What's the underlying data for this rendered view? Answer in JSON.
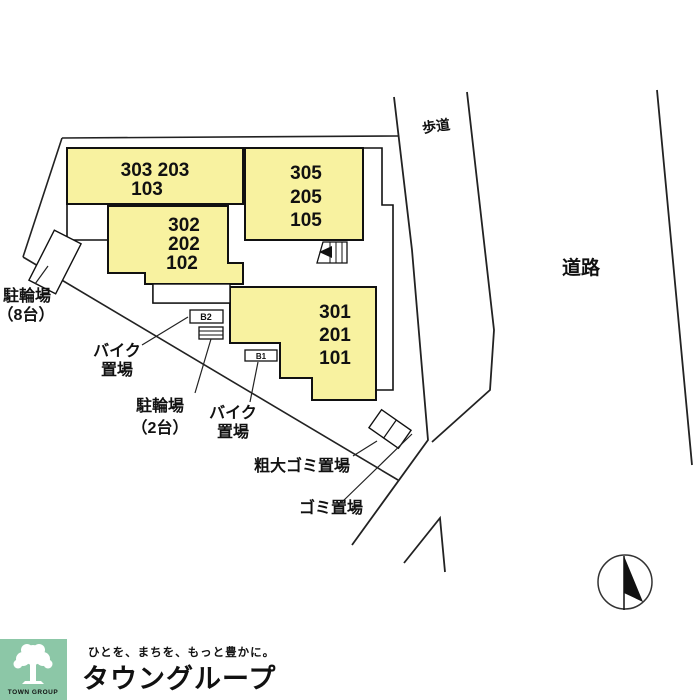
{
  "plan": {
    "area_labels": {
      "sidewalk": "歩道",
      "road": "道路"
    },
    "blocks": {
      "a": {
        "lines": [
          "303 203",
          "103"
        ]
      },
      "b": {
        "lines": [
          "302",
          "202",
          "102"
        ]
      },
      "c": {
        "lines": [
          "305",
          "205",
          "105"
        ]
      },
      "d": {
        "lines": [
          "301",
          "201",
          "101"
        ]
      }
    },
    "facilities": {
      "bicycle8": {
        "lines": [
          "駐輪場",
          "（8台）"
        ]
      },
      "bike1": {
        "lines": [
          "バイク",
          "置場"
        ]
      },
      "bicycle2": {
        "lines": [
          "駐輪場",
          "（2台）"
        ]
      },
      "bike2": {
        "lines": [
          "バイク",
          "置場"
        ]
      },
      "bulky_garbage": "粗大ゴミ置場",
      "garbage": "ゴミ置場",
      "box_b2": "B2",
      "box_b1": "B1"
    },
    "colors": {
      "block_fill": "#F8F2A0",
      "line": "#111111"
    }
  },
  "compass": {
    "type": "north-arrow"
  },
  "footer": {
    "logo_square_label": "TOWN GROUP",
    "tagline": "ひとを、まちを、もっと豊かに。",
    "brand": "タウングループ",
    "colors": {
      "square": "#8CC7A7",
      "brand": "#5BB28B",
      "tagline": "#72BC99"
    }
  }
}
